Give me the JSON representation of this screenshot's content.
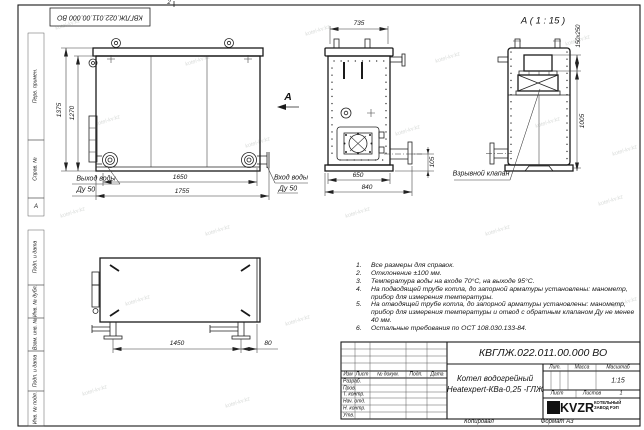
{
  "sheet": {
    "stamp_number": "КВГЛЖ.022.011.00.000 ВО",
    "fold_mark": "2",
    "zone_marker": "А",
    "copied_label": "Копировал",
    "format_label": "Формат А3"
  },
  "frame_cells": {
    "perv": "Перв. примен.",
    "sprav": "Справ. №",
    "podp1": "Подп. и дата",
    "inv_dubl": "Инв. № дубл.",
    "vzam": "Взам. инв. №",
    "podp2": "Подп. и дата",
    "inv_podl": "Инв. № подл."
  },
  "views": {
    "front": {
      "dim_height_outer": "1375",
      "dim_height_inner": "1270",
      "dim_width_inner": "1650",
      "dim_width_outer": "1755",
      "outlet_label": "Выход воды",
      "outlet_dn": "Ду 50"
    },
    "side": {
      "dim_top": "735",
      "dim_bottom_inner": "650",
      "dim_bottom_outer": "840",
      "dim_pipe_height": "105",
      "section_letter": "А",
      "inlet_label": "Вход воды",
      "inlet_dn": "Ду 50"
    },
    "detail": {
      "title": "А ( 1 : 15 )",
      "dim_valve": "150x250",
      "dim_height": "1005",
      "valve_label": "Взрывной клапан"
    },
    "top": {
      "dim_legs": "1450",
      "dim_offset": "80"
    }
  },
  "notes": {
    "items": [
      {
        "n": "1.",
        "t": "Все размеры для справок."
      },
      {
        "n": "2.",
        "t": "Отклонение ±100 мм."
      },
      {
        "n": "3.",
        "t": "Температура воды на входе 70°С, на выходе 95°С."
      },
      {
        "n": "4.",
        "t": "На подводящей трубе котла, до запорной арматуры установлены: манометр, прибор для измерения температуры."
      },
      {
        "n": "5.",
        "t": "На отводящей трубе котла, до запорной арматуры установлены: манометр, прибор для измерения температуры и отвод с обратным клапаном Ду не менее 40 мм."
      },
      {
        "n": "6.",
        "t": "Остальные требования по ОСТ 108.030.133-84."
      }
    ]
  },
  "title_block": {
    "doc_number": "КВГЛЖ.022.011.00.000 ВО",
    "name_line1": "Котел водогрейный",
    "name_line2": "Heatexpert-КВа-0,25 -ГЛЖ",
    "col_izm": "Изм",
    "col_list": "Лист",
    "col_doc": "№ докум.",
    "col_podp": "Подп.",
    "col_data": "Дата",
    "row_razrab": "Разраб.",
    "row_prov": "Пров.",
    "row_tkontr": "Т. контр.",
    "row_nachotd": "Нач. отд.",
    "row_nkontr": "Н. контр.",
    "row_utv": "Утв.",
    "lit_label": "Лит.",
    "massa_label": "Масса",
    "masshtab_label": "Масштаб",
    "scale_value": "1:15",
    "list_label": "Лист",
    "listov_label": "Листов",
    "listov_value": "1",
    "logo_text": "KVZR",
    "logo_line1": "КОТЕЛЬНЫЙ",
    "logo_line2": "ЗАВОД РЭП"
  },
  "watermark": {
    "text": "kotel-kv.kz"
  }
}
